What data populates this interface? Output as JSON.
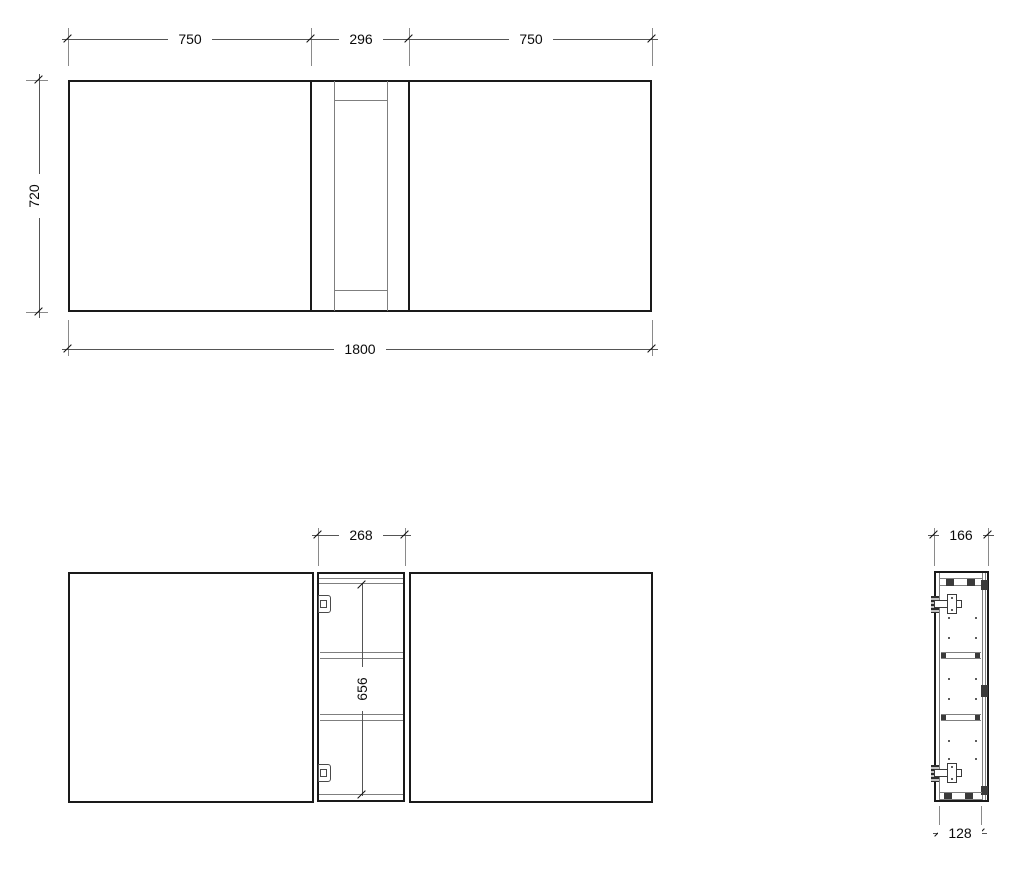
{
  "document": {
    "type": "technical-drawing",
    "subject": "wall cabinet: closed front elevation, open front elevation, side section",
    "background": "#ffffff"
  },
  "colors": {
    "outline": "#1a1a1a",
    "inner_line": "#7f7f7f",
    "dimension_line": "#555555",
    "text": "#0a0a0a",
    "fitting": "#3a3a3a"
  },
  "front_view": {
    "dim_top_left": "750",
    "dim_top_center": "296",
    "dim_top_right": "750",
    "dim_height": "720",
    "dim_total_width": "1800"
  },
  "open_view": {
    "dim_opening_width": "268",
    "dim_opening_height": "656"
  },
  "side_view": {
    "dim_depth_total": "166",
    "dim_depth_body": "128"
  }
}
